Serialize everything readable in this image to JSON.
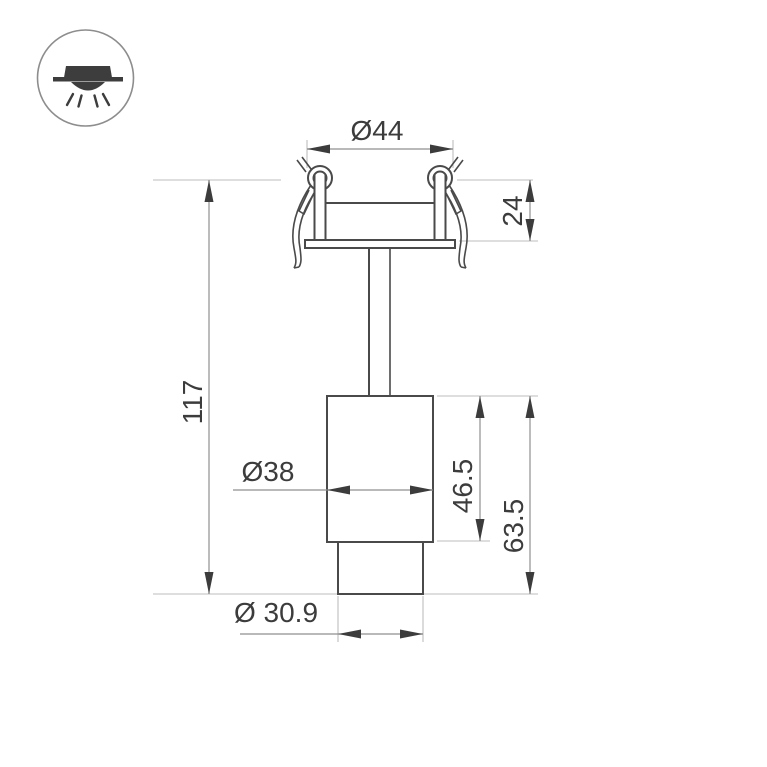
{
  "palette": {
    "background": "#ffffff",
    "fixture_outline": "#4a4a4a",
    "dimension_line": "#8f8f8f",
    "extension_line": "#bdbdbd",
    "arrow": "#3c3c3c",
    "text": "#3c3c3c",
    "icon_glyph": "#3d3d3d",
    "icon_circle": "#8d8d8d"
  },
  "dimensions": {
    "cutout_diameter": "Ø44",
    "recess_depth": "24",
    "overall_height": "117",
    "body_diameter": "Ø38",
    "body_height": "46.5",
    "lower_height": "63.5",
    "tip_diameter": "Ø 30.9"
  }
}
